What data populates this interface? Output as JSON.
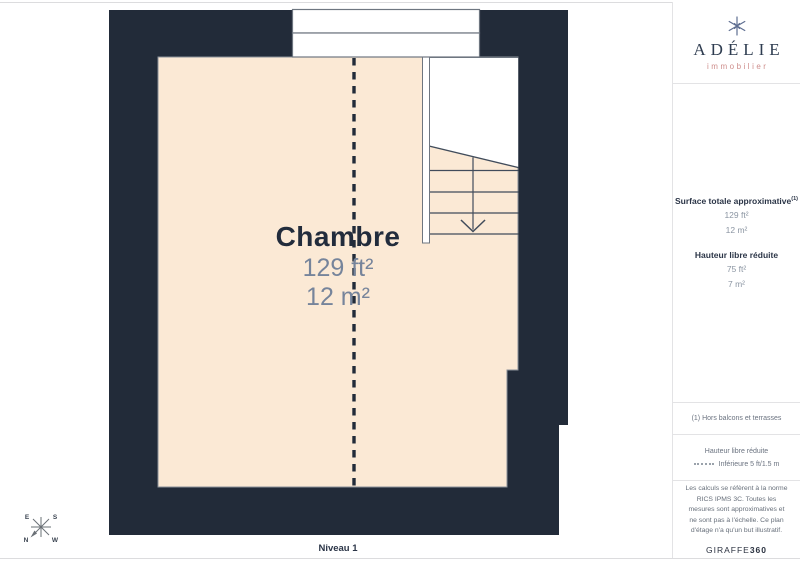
{
  "plan": {
    "room_label": "Chambre",
    "area_ft": "129 ft²",
    "area_m": "12 m²",
    "level_label": "Niveau 1",
    "compass": {
      "top_left": "E",
      "top_right": "S",
      "bottom_left": "N",
      "bottom_right": "W"
    }
  },
  "sidebar": {
    "logo": {
      "brand": "ADÉLIE",
      "tagline": "immobilier",
      "icon": "snowflake-star-icon"
    },
    "surface_section": {
      "title": "Surface totale approximative",
      "title_sup": "(1)",
      "values": [
        "129 ft²",
        "12 m²"
      ],
      "subtitle": "Hauteur libre réduite",
      "sub_values": [
        "75 ft²",
        "7 m²"
      ]
    },
    "footnote": "(1) Hors balcons et terrasses",
    "legend": {
      "title": "Hauteur libre réduite",
      "item": "Inférieure 5 ft/1.5 m"
    },
    "disclaimer": "Les calculs se réfèrent à la norme RICS IPMS 3C. Toutes les mesures sont approximatives et ne sont pas à l'échelle. Ce plan d'étage n'a qu'un but illustratif.",
    "brand_footer": {
      "name": "GIRAFFE",
      "suffix": "360"
    }
  },
  "colors": {
    "wall_dark": "#222B39",
    "floor_beige": "#FBE9D5",
    "stair_line": "#414C5B",
    "accent_pink": "#CE8E8C",
    "heading_navy": "#2B3547",
    "value_grey": "#8B95A2"
  }
}
